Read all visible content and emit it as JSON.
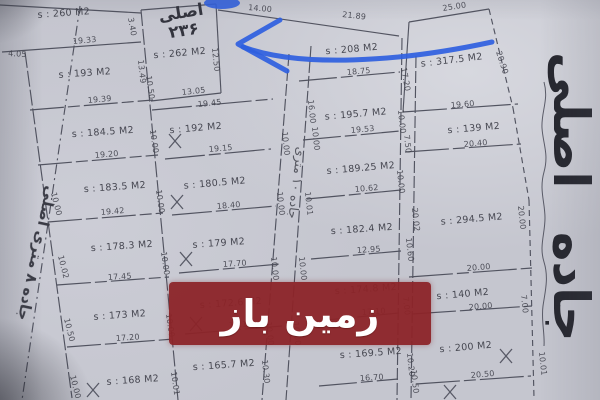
{
  "photo": {
    "paper_color": "#c5c6cf",
    "ink_color": "#454754",
    "blue_pen_color": "#2f5fe0",
    "watermark_bg": "#8c2428",
    "watermark_text_color": "#ffffff"
  },
  "texts": {
    "road_right": "جاده اصلی",
    "road_left": "جاده ۸ متری اصلی",
    "road_middle": "جاده ۱۰ متری",
    "block_title": "اصلی ۲۳۶",
    "watermark": "زمین باز"
  },
  "map": {
    "parcels": [
      [
        "s : 260 M2",
        64,
        16,
        -4
      ],
      [
        "s : 193 M2",
        85,
        76,
        -4
      ],
      [
        "s : 184.5 M2",
        103,
        135,
        -4
      ],
      [
        "s : 183.5 M2",
        115,
        190,
        -4
      ],
      [
        "s : 178.3 M2",
        122,
        249,
        -4
      ],
      [
        "s : 173 M2",
        120,
        318,
        -4
      ],
      [
        "s : 168 M2",
        133,
        383,
        -4
      ],
      [
        "s : 262 M2",
        180,
        56,
        -5
      ],
      [
        "s : 192 M2",
        196,
        131,
        -5
      ],
      [
        "s : 180.5 M2",
        215,
        186,
        -5
      ],
      [
        "s : 179 M2",
        219,
        246,
        -4
      ],
      [
        "s : 172.6 M2",
        231,
        306,
        -4
      ],
      [
        "s : 165.7 M2",
        224,
        368,
        -4
      ],
      [
        "s : 208 M2",
        352,
        52,
        -5
      ],
      [
        "s : 195.7 M2",
        356,
        117,
        -5
      ],
      [
        "s : 189.25 M2",
        361,
        171,
        -5
      ],
      [
        "s : 182.4 M2",
        362,
        232,
        -4
      ],
      [
        "s : 174.8 M2",
        366,
        292,
        -4
      ],
      [
        "s : 169.5 M2",
        371,
        356,
        -4
      ],
      [
        "s : 317.5 M2",
        452,
        63,
        -7
      ],
      [
        "s : 139 M2",
        474,
        131,
        -5
      ],
      [
        "s : 294.5 M2",
        472,
        222,
        -5
      ],
      [
        "s : 140 M2",
        463,
        297,
        -5
      ],
      [
        "s : 200 M2",
        466,
        350,
        -5
      ]
    ],
    "dims": [
      [
        "4.05",
        8,
        56,
        3
      ],
      [
        "19.33",
        73,
        44,
        -5
      ],
      [
        "14.00",
        248,
        10,
        5
      ],
      [
        "21.89",
        342,
        17,
        6
      ],
      [
        "25.00",
        443,
        11,
        -9
      ],
      [
        "3.40",
        128,
        18,
        80
      ],
      [
        "13.49",
        138,
        60,
        84
      ],
      [
        "12.50",
        212,
        48,
        84
      ],
      [
        "13.05",
        182,
        95,
        -6
      ],
      [
        "19.45",
        198,
        107,
        -6
      ],
      [
        "19.39",
        88,
        103,
        -5
      ],
      [
        "19.20",
        95,
        158,
        -5
      ],
      [
        "19.42",
        101,
        215,
        -5
      ],
      [
        "17.45",
        108,
        280,
        -4
      ],
      [
        "17.20",
        116,
        341,
        -4
      ],
      [
        "19.15",
        209,
        152,
        -5
      ],
      [
        "18.40",
        217,
        209,
        -5
      ],
      [
        "17.70",
        223,
        267,
        -4
      ],
      [
        "17.10",
        229,
        328,
        -4
      ],
      [
        "18.75",
        347,
        75,
        -5
      ],
      [
        "19.53",
        351,
        133,
        -5
      ],
      [
        "10.62",
        355,
        192,
        -5
      ],
      [
        "12.95",
        357,
        253,
        -4
      ],
      [
        "17.10",
        362,
        315,
        -4
      ],
      [
        "16.70",
        360,
        381,
        -4
      ],
      [
        "19.60",
        451,
        108,
        -5
      ],
      [
        "20.40",
        464,
        147,
        -5
      ],
      [
        "20.00",
        467,
        271,
        -5
      ],
      [
        "20.00",
        469,
        310,
        -5
      ],
      [
        "20.50",
        471,
        378,
        -5
      ],
      [
        "17.20",
        401,
        68,
        80
      ],
      [
        "20.90",
        496,
        52,
        72
      ],
      [
        "7.50",
        404,
        135,
        84
      ],
      [
        "20.02",
        412,
        208,
        84
      ],
      [
        "10.60",
        406,
        238,
        84
      ],
      [
        "7.00",
        403,
        297,
        84
      ],
      [
        "10.20",
        407,
        353,
        84
      ],
      [
        "10.50",
        411,
        370,
        84
      ],
      [
        "20.00",
        518,
        206,
        84
      ],
      [
        "7.00",
        521,
        295,
        84
      ],
      [
        "10.01",
        539,
        352,
        84
      ],
      [
        "10.00",
        51,
        193,
        76
      ],
      [
        "10.02",
        58,
        256,
        76
      ],
      [
        "10.50",
        64,
        319,
        76
      ],
      [
        "10.00",
        70,
        376,
        76
      ],
      [
        "10.50",
        146,
        76,
        82
      ],
      [
        "10.00",
        150,
        130,
        82
      ],
      [
        "10.00",
        156,
        190,
        82
      ],
      [
        "10.00",
        161,
        252,
        82
      ],
      [
        "10.00",
        166,
        314,
        82
      ],
      [
        "10.01",
        171,
        372,
        82
      ],
      [
        "10.00",
        282,
        132,
        84
      ],
      [
        "10.00",
        277,
        192,
        84
      ],
      [
        "10.00",
        271,
        257,
        84
      ],
      [
        "10.00",
        266,
        322,
        84
      ],
      [
        "10.30",
        262,
        360,
        84
      ],
      [
        "16.00",
        308,
        100,
        84
      ],
      [
        "10.00",
        312,
        127,
        84
      ],
      [
        "10.01",
        305,
        192,
        84
      ],
      [
        "10.00",
        299,
        257,
        84
      ],
      [
        "10.00",
        293,
        322,
        84
      ],
      [
        "10.00",
        398,
        110,
        84
      ],
      [
        "10.00",
        397,
        170,
        84
      ]
    ],
    "lines": [
      [
        80,
        6,
        22,
        400,
        "10 4 2 4"
      ],
      [
        25,
        52,
        72,
        398,
        "16 3"
      ],
      [
        141,
        10,
        178,
        400,
        "16 3"
      ],
      [
        289,
        54,
        262,
        400,
        "12 3"
      ],
      [
        311,
        46,
        286,
        400,
        "12 3"
      ],
      [
        402,
        38,
        397,
        400,
        "12 3"
      ],
      [
        416,
        56,
        411,
        400,
        "12 3"
      ],
      [
        489,
        9,
        513,
        108,
        "6 4"
      ],
      [
        513,
        108,
        529,
        200,
        "6 4"
      ],
      [
        529,
        200,
        534,
        398,
        "6 4"
      ],
      [
        141,
        10,
        216,
        4,
        null
      ],
      [
        216,
        4,
        221,
        93,
        null
      ],
      [
        151,
        101,
        221,
        93,
        null
      ],
      [
        218,
        10,
        399,
        36,
        null
      ],
      [
        409,
        22,
        489,
        9,
        null
      ],
      [
        409,
        22,
        403,
        112,
        null
      ],
      [
        0,
        5,
        141,
        13,
        null
      ],
      [
        2,
        52,
        141,
        42,
        null
      ],
      [
        30,
        110,
        153,
        100,
        "34 4 12 4"
      ],
      [
        38,
        165,
        158,
        155,
        "34 4 12 4"
      ],
      [
        48,
        222,
        163,
        213,
        "34 4 12 4"
      ],
      [
        57,
        285,
        169,
        277,
        "34 4 12 4"
      ],
      [
        67,
        347,
        174,
        339,
        "34 4 12 4"
      ],
      [
        152,
        110,
        273,
        99,
        "40 4 12 4"
      ],
      [
        165,
        159,
        271,
        149,
        "40 4 12 4"
      ],
      [
        172,
        215,
        276,
        206,
        "40 4 12 4"
      ],
      [
        179,
        273,
        280,
        264,
        "40 4 12 4"
      ],
      [
        185,
        334,
        282,
        326,
        "40 4 12 4"
      ],
      [
        299,
        81,
        400,
        72,
        "38 4 12 4"
      ],
      [
        303,
        140,
        400,
        131,
        "38 4 12 4"
      ],
      [
        307,
        199,
        401,
        190,
        "38 4 12 4"
      ],
      [
        311,
        259,
        401,
        251,
        "38 4 12 4"
      ],
      [
        315,
        321,
        399,
        313,
        "38 4 12 4"
      ],
      [
        319,
        386,
        398,
        379,
        "38 4 12 4"
      ],
      [
        403,
        112,
        518,
        104,
        "44 4 12 4"
      ],
      [
        405,
        152,
        521,
        144,
        "44 4 12 4"
      ],
      [
        409,
        277,
        532,
        268,
        "44 4 12 4"
      ],
      [
        412,
        314,
        532,
        306,
        "44 4 12 4"
      ],
      [
        416,
        384,
        531,
        376,
        "44 4 12 4"
      ]
    ],
    "paths": [
      "M 544 82 c 5 18 -3 30 -2 46 c 1 16 7 26 2 44 c -5 18 1 30 1 46 c 0 16 -6 28 -1 44 c 5 16 1 30 -1 44 c -2 14 2 28 1 40"
    ],
    "xmarks": [
      [
        175,
        141
      ],
      [
        177,
        202
      ],
      [
        186,
        259
      ],
      [
        196,
        324
      ],
      [
        93,
        390
      ],
      [
        506,
        356
      ],
      [
        450,
        392
      ]
    ],
    "blue": {
      "paths": [
        "M 280 20 L 238 44 L 287 71",
        "M 243 47 C 300 68 400 62 492 42"
      ],
      "blob": {
        "cx": 222,
        "cy": 3,
        "rx": 18,
        "ry": 6
      }
    }
  }
}
